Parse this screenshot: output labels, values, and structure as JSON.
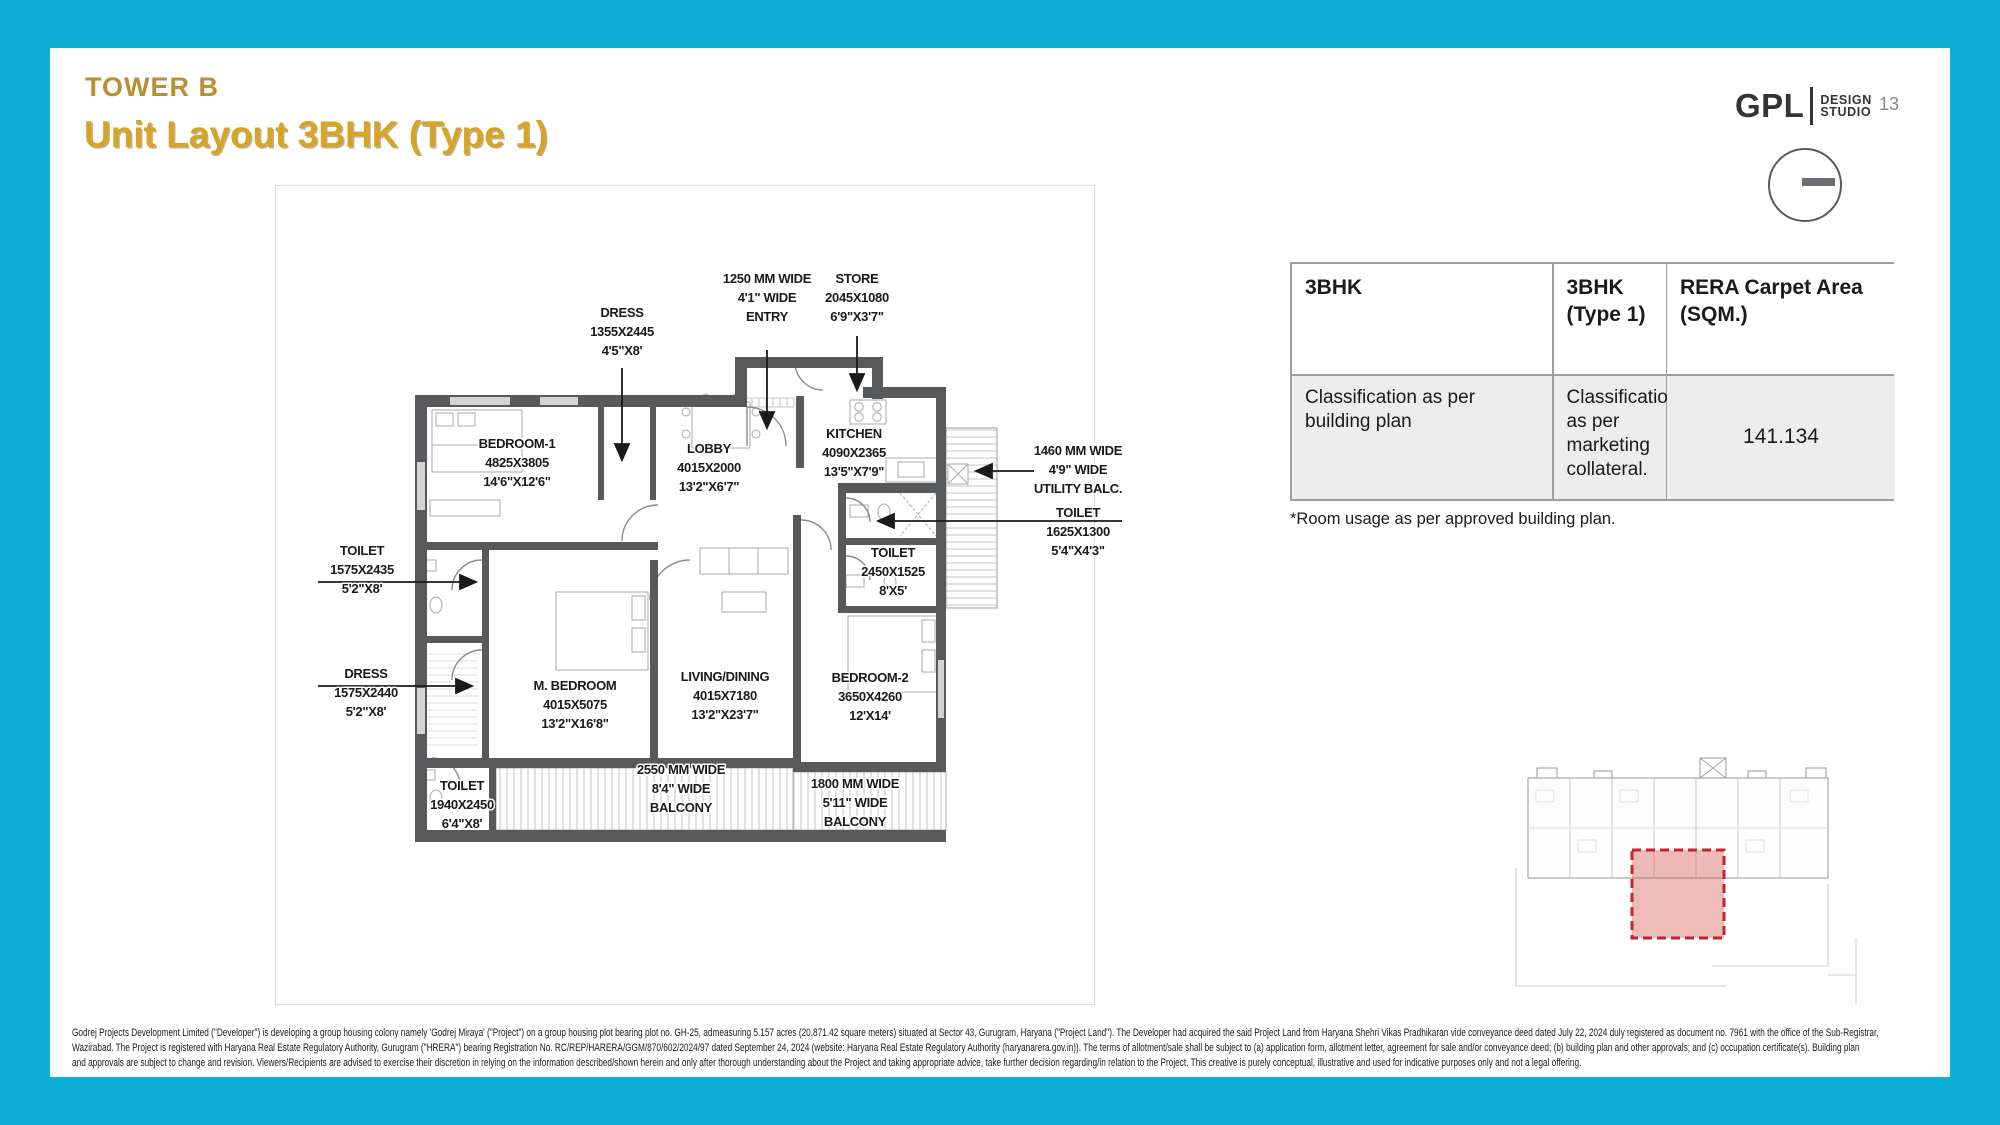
{
  "header": {
    "eyebrow": "TOWER B",
    "title": "Unit Layout 3BHK (Type 1)",
    "page_number": "13",
    "logo": {
      "brand": "GPL",
      "sub1": "DESIGN",
      "sub2": "STUDIO"
    }
  },
  "table": {
    "columns": [
      {
        "header": "3BHK",
        "cell": "Classification as per building plan"
      },
      {
        "header": "3BHK (Type 1)",
        "cell": "Classification as per marketing collateral."
      },
      {
        "header": "RERA Carpet Area (SQM.)",
        "cell": "141.134"
      }
    ],
    "footnote": "*Room usage as per approved building plan."
  },
  "plan": {
    "labels": [
      {
        "id": "label-dress-upper",
        "cx": 622,
        "y": 317,
        "rows": [
          "DRESS",
          "1355X2445",
          "4'5\"X8'"
        ]
      },
      {
        "id": "label-entry",
        "cx": 767,
        "y": 283,
        "rows": [
          "1250 MM WIDE",
          "4'1\" WIDE",
          "ENTRY"
        ]
      },
      {
        "id": "label-store",
        "cx": 857,
        "y": 283,
        "rows": [
          "STORE",
          "2045X1080",
          "6'9\"X3'7\""
        ]
      },
      {
        "id": "label-bedroom-1",
        "cx": 517,
        "y": 448,
        "rows": [
          "BEDROOM-1",
          "4825X3805",
          "14'6\"X12'6\""
        ]
      },
      {
        "id": "label-lobby",
        "cx": 709,
        "y": 453,
        "rows": [
          "LOBBY",
          "4015X2000",
          "13'2\"X6'7\""
        ]
      },
      {
        "id": "label-kitchen",
        "cx": 854,
        "y": 438,
        "rows": [
          "KITCHEN",
          "4090X2365",
          "13'5\"X7'9\""
        ]
      },
      {
        "id": "label-utility-balc",
        "cx": 1078,
        "y": 455,
        "rows": [
          "1460 MM WIDE",
          "4'9\" WIDE",
          "UTILITY BALC."
        ]
      },
      {
        "id": "label-toilet-1625",
        "cx": 1078,
        "y": 517,
        "rows": [
          "TOILET",
          "1625X1300",
          "5'4\"X4'3\""
        ]
      },
      {
        "id": "label-toilet-2450",
        "cx": 893,
        "y": 557,
        "rows": [
          "TOILET",
          "2450X1525",
          "8'X5'"
        ]
      },
      {
        "id": "label-toilet-1575",
        "cx": 362,
        "y": 555,
        "rows": [
          "TOILET",
          "1575X2435",
          "5'2\"X8'"
        ]
      },
      {
        "id": "label-dress-left",
        "cx": 366,
        "y": 678,
        "rows": [
          "DRESS",
          "1575X2440",
          "5'2\"X8'"
        ]
      },
      {
        "id": "label-m-bedroom",
        "cx": 575,
        "y": 690,
        "rows": [
          "M. BEDROOM",
          "4015X5075",
          "13'2\"X16'8\""
        ]
      },
      {
        "id": "label-living-dining",
        "cx": 725,
        "y": 681,
        "rows": [
          "LIVING/DINING",
          "4015X7180",
          "13'2\"X23'7\""
        ]
      },
      {
        "id": "label-bedroom-2",
        "cx": 870,
        "y": 682,
        "rows": [
          "BEDROOM-2",
          "3650X4260",
          "12'X14'"
        ]
      },
      {
        "id": "label-balcony-2550",
        "cx": 681,
        "y": 774,
        "rows": [
          "2550 MM WIDE",
          "8'4\" WIDE",
          "BALCONY"
        ]
      },
      {
        "id": "label-balcony-1800",
        "cx": 855,
        "y": 788,
        "rows": [
          "1800 MM WIDE",
          "5'11\" WIDE",
          "BALCONY"
        ]
      },
      {
        "id": "label-toilet-1940",
        "cx": 462,
        "y": 790,
        "rows": [
          "TOILET",
          "1940X2450",
          "6'4\"X8'"
        ]
      }
    ]
  },
  "disclaimer": {
    "lines": [
      "Godrej Projects Development Limited (\"Developer\") is developing a group housing colony namely 'Godrej Miraya' (\"Project\") on a group housing plot bearing plot no. GH-25, admeasuring 5.157 acres (20,871.42 square meters) situated at Sector 43, Gurugram, Haryana (\"Project Land\"). The Developer had acquired the said Project Land from Haryana Shehri Vikas Pradhikaran vide conveyance deed dated July 22, 2024 duly registered as document no. 7961 with the office of the Sub-Registrar,",
      "Wazirabad. The Project is registered with Haryana Real Estate Regulatory Authority, Gurugram (\"HRERA\") bearing Registration No. RC/REP/HARERA/GGM/870/602/2024/97 dated September 24, 2024 (website: Haryana Real Estate Regulatory Authority (haryanarera.gov.in)). The terms of allotment/sale shall be subject to (a) application form, allotment letter, agreement for sale and/or conveyance deed; (b) building plan and other approvals; and (c) occupation certificate(s). Building plan",
      "and approvals are subject to change and revision. Viewers/Recipients are advised to exercise their discretion in relying on the information described/shown herein and only after thorough understanding about the Project and taking appropriate advice, take further decision regarding/in relation to the Project. This creative is purely conceptual, illustrative and used for indicative purposes only and not a legal offering."
    ]
  },
  "colors": {
    "border_cyan": "#0FAFD8",
    "gold_title": "#D8A426",
    "gold_eyebrow": "#BA8F33",
    "wall_gray": "#58595B",
    "highlight_red": "#C0272D"
  }
}
